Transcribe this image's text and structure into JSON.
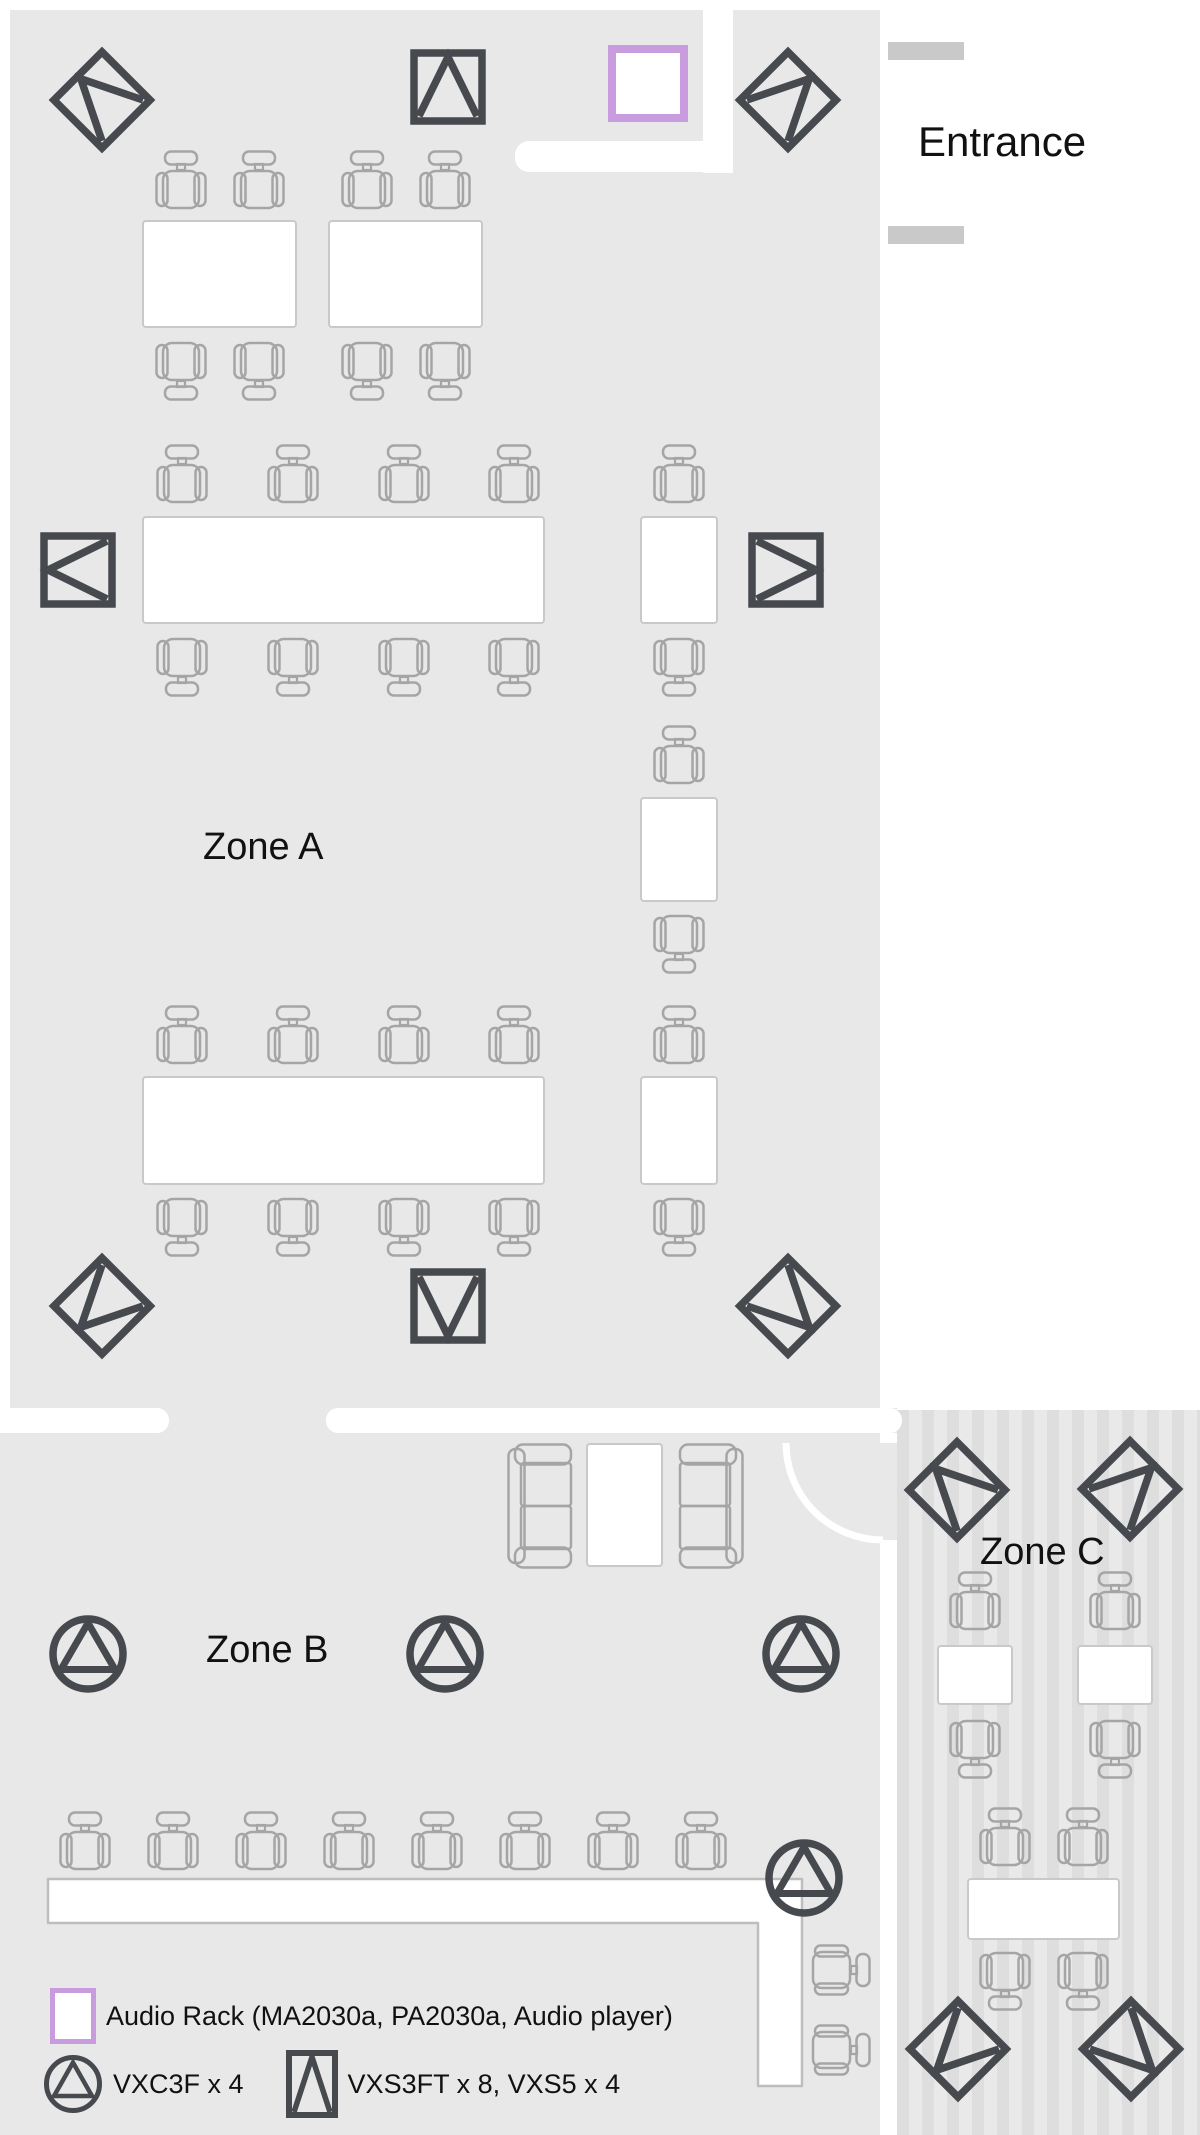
{
  "labels": {
    "entrance": "Entrance",
    "zone_a": "Zone A",
    "zone_b": "Zone B",
    "zone_c": "Zone C"
  },
  "legend": {
    "audio_rack_label": "Audio Rack (MA2030a, PA2030a, Audio player)",
    "ceiling_speaker_label": "VXC3F x 4",
    "surface_speaker_label": "VXS3FT x 8, VXS5 x 4"
  },
  "colors": {
    "room": "#e8e8e8",
    "stripe_light": "#e9e9e9",
    "stripe_dark": "#dedede",
    "furniture": "#a5a5a5",
    "table_border": "#c9c9c9",
    "speaker": "#46494d",
    "purple": "#c99ce0",
    "door_post": "#c9c9c9",
    "text": "#111111"
  },
  "plan": {
    "zones": {
      "a": {
        "x": 10,
        "y": 10,
        "w": 870,
        "h": 1398
      },
      "b": {
        "x": 0,
        "y": 1433,
        "w": 880,
        "h": 702
      },
      "c": {
        "x": 897,
        "y": 1410,
        "w": 303,
        "h": 725
      }
    },
    "walls": {
      "strip": {
        "x": 0,
        "y": 1408,
        "w": 897,
        "h": 25
      },
      "bars": [
        {
          "x": -15,
          "y": 1408,
          "w": 184,
          "h": 25
        },
        {
          "x": 326,
          "y": 1408,
          "w": 576,
          "h": 25
        }
      ],
      "notch_v": {
        "x": 703,
        "y": 10,
        "w": 30,
        "h": 163
      },
      "notch_h": {
        "x": 515,
        "y": 141,
        "w": 218,
        "h": 31
      },
      "posts": [
        {
          "x": 888,
          "y": 42,
          "w": 76,
          "h": 18
        },
        {
          "x": 888,
          "y": 226,
          "w": 76,
          "h": 18
        }
      ],
      "door_gap": {
        "x": 880,
        "y": 1443,
        "w": 17,
        "h": 97
      },
      "door_arc": {
        "x": 778,
        "y": 1439,
        "r": 97
      }
    },
    "audio_rack": {
      "x": 608,
      "y": 45,
      "w": 80,
      "h": 77
    },
    "vxs_speakers": [
      {
        "cx": 102,
        "cy": 100,
        "rot": -45
      },
      {
        "cx": 448,
        "cy": 87,
        "rot": 0
      },
      {
        "cx": 788,
        "cy": 100,
        "rot": 45
      },
      {
        "cx": 78,
        "cy": 570,
        "rot": -90
      },
      {
        "cx": 786,
        "cy": 570,
        "rot": 90
      },
      {
        "cx": 102,
        "cy": 1306,
        "rot": -135
      },
      {
        "cx": 448,
        "cy": 1306,
        "rot": 180
      },
      {
        "cx": 788,
        "cy": 1306,
        "rot": 135
      },
      {
        "cx": 957,
        "cy": 1490,
        "rot": -45
      },
      {
        "cx": 1130,
        "cy": 1489,
        "rot": 45
      },
      {
        "cx": 958,
        "cy": 2049,
        "rot": -135
      },
      {
        "cx": 1131,
        "cy": 2049,
        "rot": 135
      }
    ],
    "vxc_speakers": [
      {
        "cx": 88,
        "cy": 1654
      },
      {
        "cx": 445,
        "cy": 1654
      },
      {
        "cx": 801,
        "cy": 1654
      },
      {
        "cx": 804,
        "cy": 1878
      }
    ],
    "tables": [
      {
        "x": 142,
        "y": 220,
        "w": 155,
        "h": 108
      },
      {
        "x": 328,
        "y": 220,
        "w": 155,
        "h": 108
      },
      {
        "x": 142,
        "y": 516,
        "w": 403,
        "h": 108
      },
      {
        "x": 640,
        "y": 516,
        "w": 78,
        "h": 108
      },
      {
        "x": 640,
        "y": 797,
        "w": 78,
        "h": 105
      },
      {
        "x": 142,
        "y": 1076,
        "w": 403,
        "h": 109
      },
      {
        "x": 640,
        "y": 1076,
        "w": 78,
        "h": 109
      },
      {
        "x": 586,
        "y": 1443,
        "w": 77,
        "h": 124
      },
      {
        "x": 937,
        "y": 1645,
        "w": 76,
        "h": 60
      },
      {
        "x": 1077,
        "y": 1645,
        "w": 76,
        "h": 60
      },
      {
        "x": 967,
        "y": 1878,
        "w": 153,
        "h": 62
      }
    ],
    "chairs": [
      {
        "cx": 181,
        "cy": 180,
        "rot": 0
      },
      {
        "cx": 259,
        "cy": 180,
        "rot": 0
      },
      {
        "cx": 367,
        "cy": 180,
        "rot": 0
      },
      {
        "cx": 445,
        "cy": 180,
        "rot": 0
      },
      {
        "cx": 181,
        "cy": 371,
        "rot": 180
      },
      {
        "cx": 259,
        "cy": 371,
        "rot": 180
      },
      {
        "cx": 367,
        "cy": 371,
        "rot": 180
      },
      {
        "cx": 445,
        "cy": 371,
        "rot": 180
      },
      {
        "cx": 182,
        "cy": 474,
        "rot": 0
      },
      {
        "cx": 293,
        "cy": 474,
        "rot": 0
      },
      {
        "cx": 404,
        "cy": 474,
        "rot": 0
      },
      {
        "cx": 514,
        "cy": 474,
        "rot": 0
      },
      {
        "cx": 679,
        "cy": 474,
        "rot": 0
      },
      {
        "cx": 182,
        "cy": 667,
        "rot": 180
      },
      {
        "cx": 293,
        "cy": 667,
        "rot": 180
      },
      {
        "cx": 404,
        "cy": 667,
        "rot": 180
      },
      {
        "cx": 514,
        "cy": 667,
        "rot": 180
      },
      {
        "cx": 679,
        "cy": 667,
        "rot": 180
      },
      {
        "cx": 679,
        "cy": 755,
        "rot": 0
      },
      {
        "cx": 679,
        "cy": 944,
        "rot": 180
      },
      {
        "cx": 182,
        "cy": 1035,
        "rot": 0
      },
      {
        "cx": 293,
        "cy": 1035,
        "rot": 0
      },
      {
        "cx": 404,
        "cy": 1035,
        "rot": 0
      },
      {
        "cx": 514,
        "cy": 1035,
        "rot": 0
      },
      {
        "cx": 679,
        "cy": 1035,
        "rot": 0
      },
      {
        "cx": 182,
        "cy": 1227,
        "rot": 180
      },
      {
        "cx": 293,
        "cy": 1227,
        "rot": 180
      },
      {
        "cx": 404,
        "cy": 1227,
        "rot": 180
      },
      {
        "cx": 514,
        "cy": 1227,
        "rot": 180
      },
      {
        "cx": 679,
        "cy": 1227,
        "rot": 180
      },
      {
        "cx": 85,
        "cy": 1841,
        "rot": 0
      },
      {
        "cx": 173,
        "cy": 1841,
        "rot": 0
      },
      {
        "cx": 261,
        "cy": 1841,
        "rot": 0
      },
      {
        "cx": 349,
        "cy": 1841,
        "rot": 0
      },
      {
        "cx": 437,
        "cy": 1841,
        "rot": 0
      },
      {
        "cx": 525,
        "cy": 1841,
        "rot": 0
      },
      {
        "cx": 613,
        "cy": 1841,
        "rot": 0
      },
      {
        "cx": 701,
        "cy": 1841,
        "rot": 0
      },
      {
        "cx": 841,
        "cy": 1970,
        "rot": 90
      },
      {
        "cx": 841,
        "cy": 2050,
        "rot": 90
      },
      {
        "cx": 975,
        "cy": 1601,
        "rot": 0
      },
      {
        "cx": 1115,
        "cy": 1601,
        "rot": 0
      },
      {
        "cx": 975,
        "cy": 1749,
        "rot": 180
      },
      {
        "cx": 1115,
        "cy": 1749,
        "rot": 180
      },
      {
        "cx": 1005,
        "cy": 1837,
        "rot": 0
      },
      {
        "cx": 1083,
        "cy": 1837,
        "rot": 0
      },
      {
        "cx": 1005,
        "cy": 1981,
        "rot": 180
      },
      {
        "cx": 1083,
        "cy": 1981,
        "rot": 180
      }
    ],
    "sofas": [
      {
        "x": 507,
        "y": 1443,
        "mirror": false
      },
      {
        "x": 678,
        "y": 1443,
        "mirror": true
      }
    ],
    "counter_points": "8,9 762,9 762,216 718,216 718,53 8,53",
    "counter_box": {
      "x": 40,
      "y": 1870,
      "w": 770,
      "h": 225
    }
  }
}
